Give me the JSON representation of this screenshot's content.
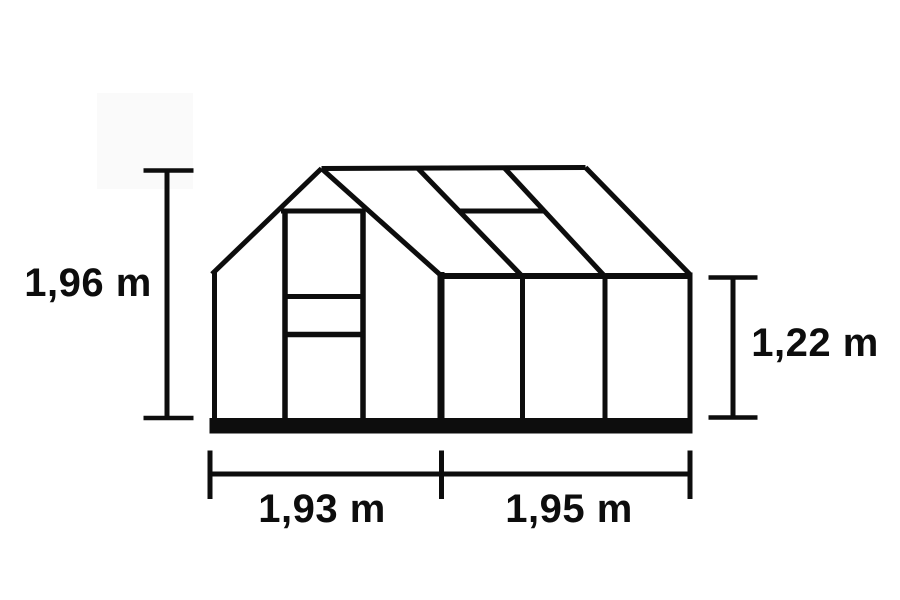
{
  "canvas": {
    "background": "#ffffff",
    "ink_color": "#0d0d0d",
    "width": 900,
    "height": 600
  },
  "diagram": {
    "subject": "greenhouse line drawing with dimension lines",
    "dimensions": {
      "ridge_height": {
        "label": "1,96 m",
        "value_m": 1.96,
        "position": "left"
      },
      "eave_height": {
        "label": "1,22 m",
        "value_m": 1.22,
        "position": "right"
      },
      "front_width": {
        "label": "1,93 m",
        "value_m": 1.93,
        "position": "bottom-left"
      },
      "side_length": {
        "label": "1,95 m",
        "value_m": 1.95,
        "position": "bottom-right"
      }
    }
  }
}
